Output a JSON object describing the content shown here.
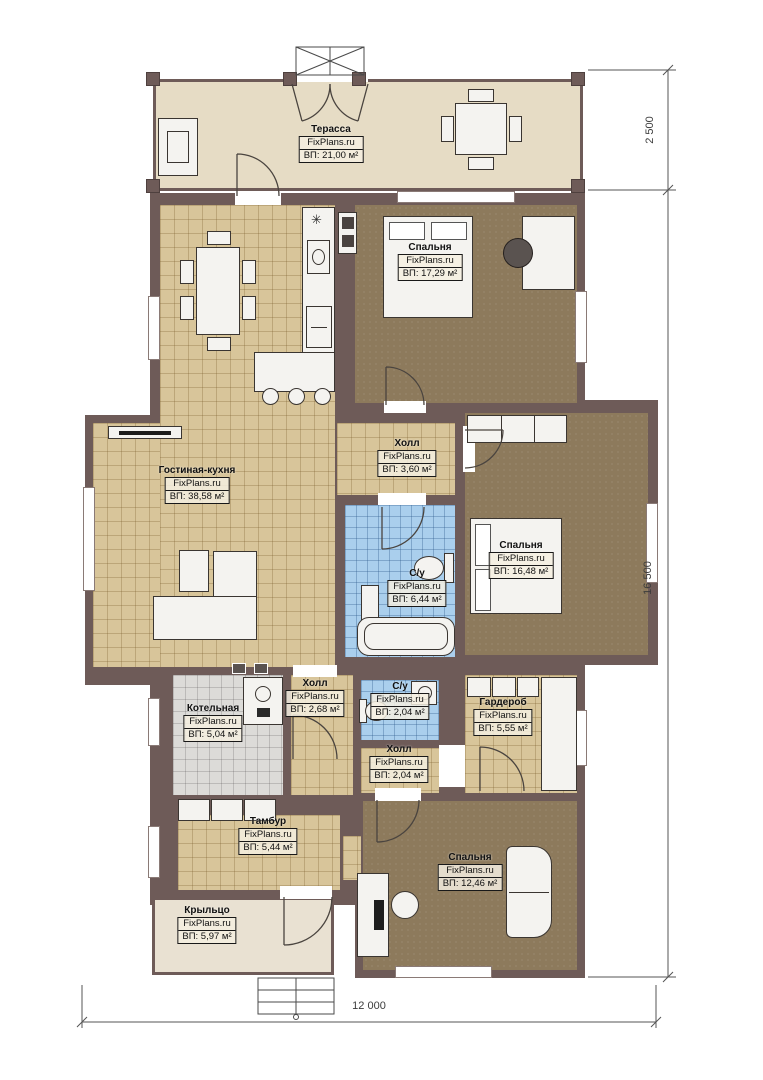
{
  "plan": {
    "watermark": "FixPlans.ru",
    "rooms": [
      {
        "name": "Терасса",
        "area": "ВП: 21,00 м²"
      },
      {
        "name": "Спальня",
        "area": "ВП: 17,29 м²"
      },
      {
        "name": "Холл",
        "area": "ВП: 3,60 м²"
      },
      {
        "name": "Гостиная-кухня",
        "area": "ВП: 38,58 м²"
      },
      {
        "name": "Спальня",
        "area": "ВП: 16,48 м²"
      },
      {
        "name": "С/у",
        "area": "ВП: 6,44 м²"
      },
      {
        "name": "Котельная",
        "area": "ВП: 5,04 м²"
      },
      {
        "name": "Холл",
        "area": "ВП: 2,68 м²"
      },
      {
        "name": "С/у",
        "area": "ВП: 2,04 м²"
      },
      {
        "name": "Гардероб",
        "area": "ВП: 5,55 м²"
      },
      {
        "name": "Холл",
        "area": "ВП: 2,04 м²"
      },
      {
        "name": "Тамбур",
        "area": "ВП: 5,44 м²"
      },
      {
        "name": "Спальня",
        "area": "ВП: 12,46 м²"
      },
      {
        "name": "Крыльцо",
        "area": "ВП: 5,97 м²"
      }
    ],
    "dimensions": {
      "right_top": "2 500",
      "right_side": "16 500",
      "bottom": "12 000"
    },
    "colors": {
      "wall": "#6e5b58",
      "terrace_floor": "#e6dcc5",
      "tile_tan": "#d8c59a",
      "carpet_brown": "#8d7a5c",
      "tile_blue": "#aacfed",
      "tile_gray": "#dcdbd8",
      "porch_floor": "#e9e1d2"
    }
  }
}
